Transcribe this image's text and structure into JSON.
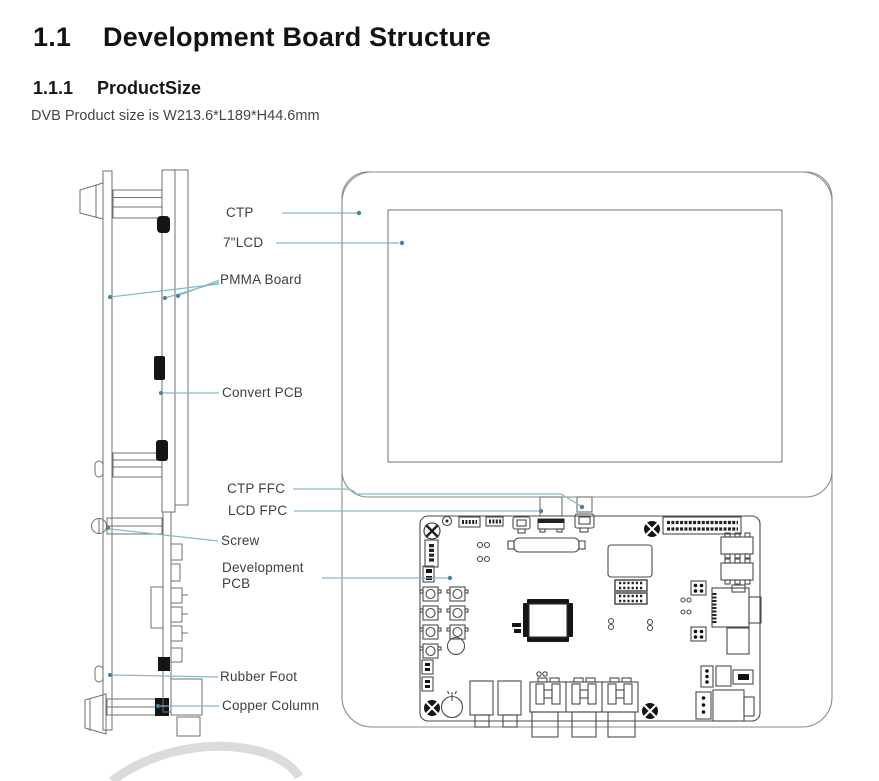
{
  "doc": {
    "section_number": "1.1",
    "section_title": "Development Board Structure",
    "subsection_number": "1.1.1",
    "subsection_title": "ProductSize",
    "body_text": "DVB Product size is W213.6*L189*H44.6mm"
  },
  "figure": {
    "description": "Exploded side view and front view of the DVB development board assembly",
    "labels": [
      {
        "id": "ctp",
        "text": "CTP"
      },
      {
        "id": "lcd-7in",
        "text": "7\"LCD"
      },
      {
        "id": "pmma-board",
        "text": "PMMA Board"
      },
      {
        "id": "convert-pcb",
        "text": "Convert PCB"
      },
      {
        "id": "ctp-ffc",
        "text": "CTP FFC"
      },
      {
        "id": "lcd-fpc",
        "text": "LCD FPC"
      },
      {
        "id": "screw",
        "text": "Screw"
      },
      {
        "id": "development-pcb",
        "text": "Development PCB"
      },
      {
        "id": "rubber-foot",
        "text": "Rubber Foot"
      },
      {
        "id": "copper-column",
        "text": "Copper Column"
      }
    ],
    "colors": {
      "leader_line": "#86b8c7",
      "leader_dot": "#49829b",
      "outline": "#6f6f6f",
      "component_dark": "#151515",
      "watermark": "#dbdbdb"
    }
  }
}
